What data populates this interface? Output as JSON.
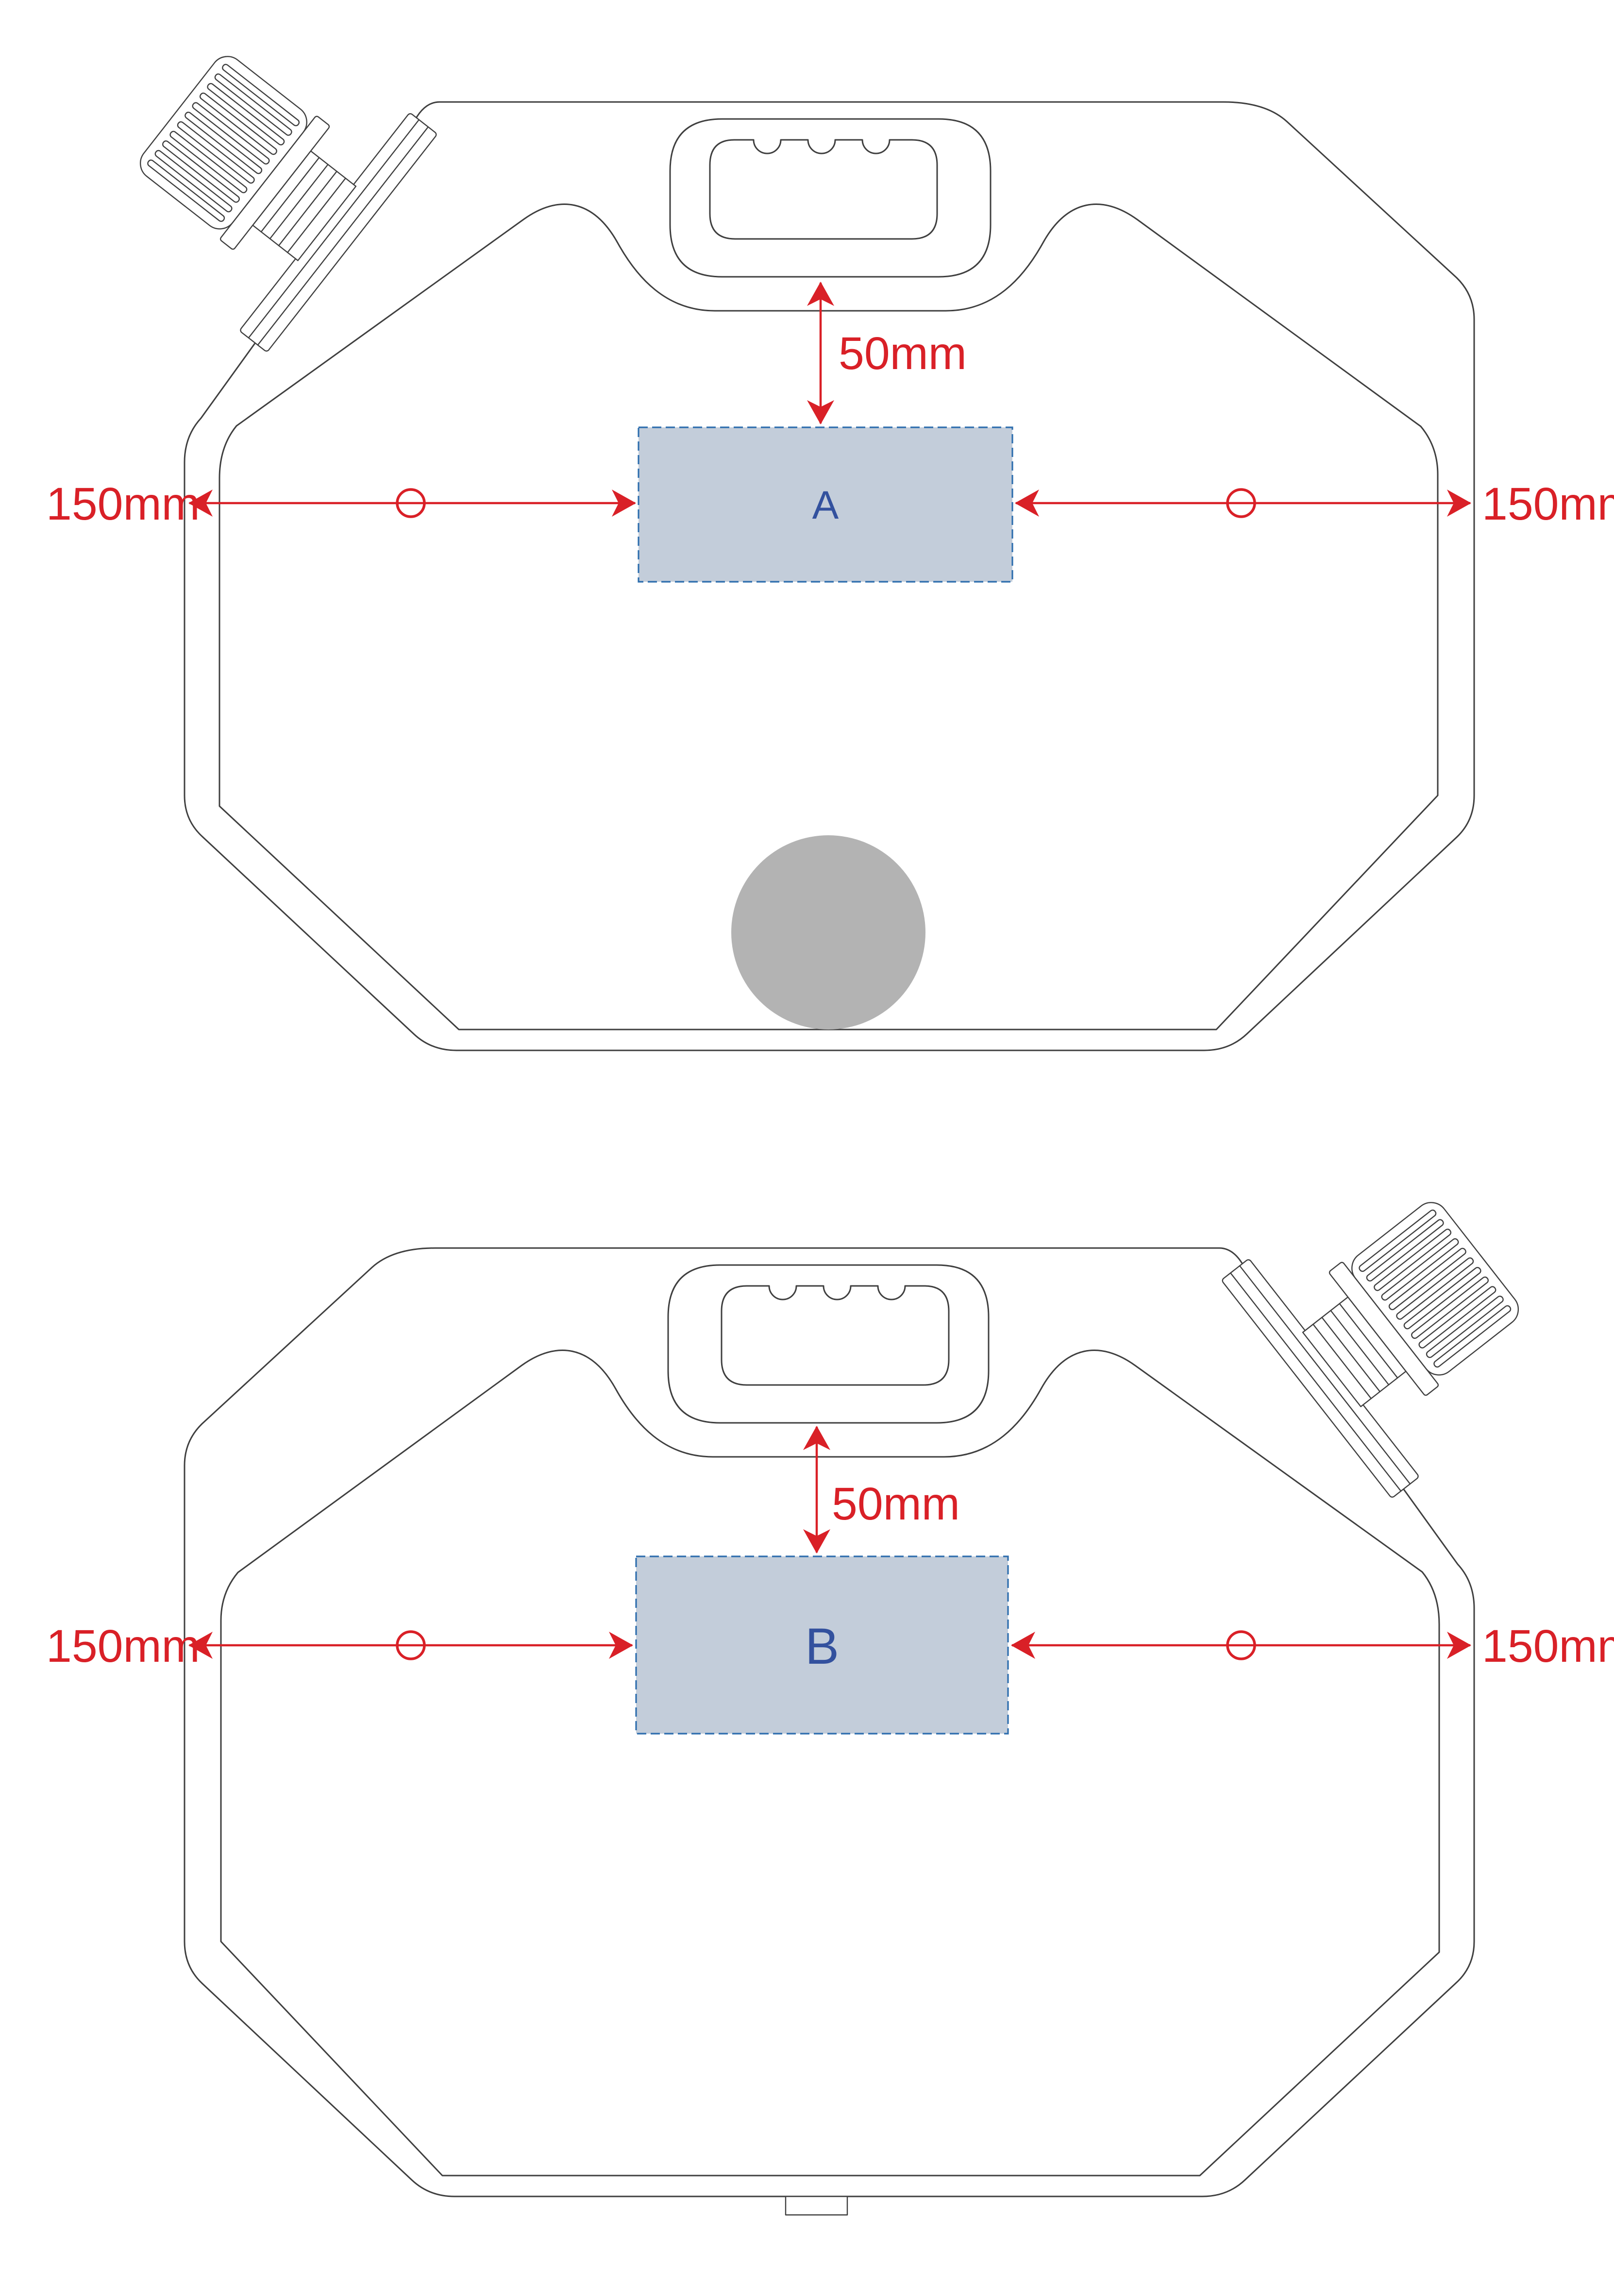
{
  "diagram": {
    "jug_top": {
      "panel_label": "A",
      "dim_top": "50mm",
      "dim_left": "150mm",
      "dim_right": "150mm"
    },
    "jug_bottom": {
      "panel_label": "B",
      "dim_top": "50mm",
      "dim_left": "150mm",
      "dim_right": "150mm"
    }
  },
  "colors": {
    "red": "#d92027",
    "panel_fill": "#c3cdda",
    "panel_border": "#2e6eae",
    "panel_label": "#33519e",
    "outline": "#3f3f3f",
    "spot_gray": "#b3b3b3",
    "background": "#ffffff"
  }
}
